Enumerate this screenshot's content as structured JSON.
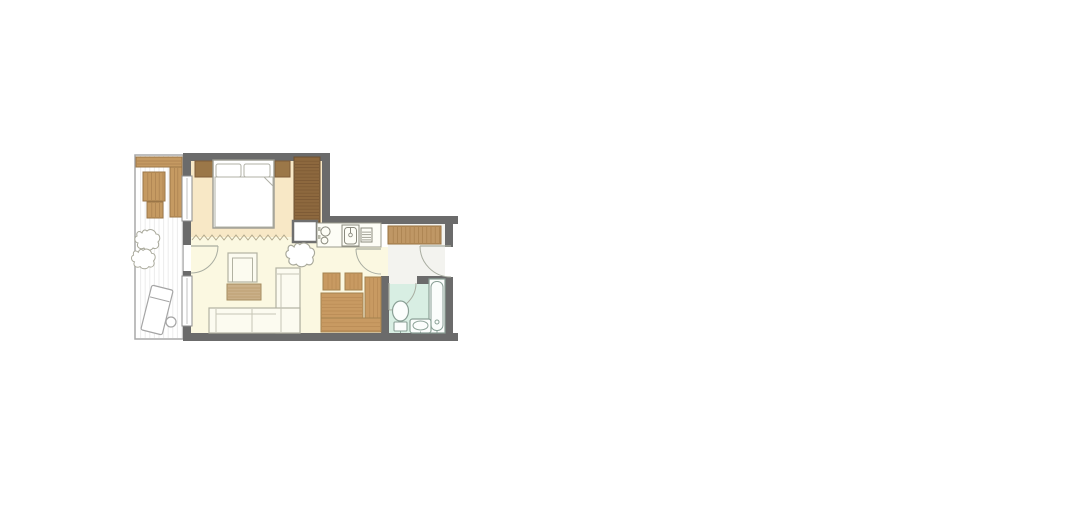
{
  "canvas": {
    "width": 1070,
    "height": 477,
    "background": "#ffffff"
  },
  "palette": {
    "wall": "#6b6b6b",
    "oak_wood": "#c59a62",
    "oak_grain": "#aa8150",
    "walnut_wood": "#8d683e",
    "walnut_grain": "#7a5733",
    "bedroom_floor": "#f8e8c6",
    "living_floor": "#fbf8e1",
    "hall_floor": "#f3f3ef",
    "bathroom_floor": "#d8eee3",
    "balcony_floor": "#ffffff",
    "furniture_outline": "#b2b2a2",
    "fixture_outline": "#8aa096",
    "door_swing": "#a9ada1"
  },
  "rooms": [
    {
      "name": "balcony"
    },
    {
      "name": "bedroom"
    },
    {
      "name": "living-room"
    },
    {
      "name": "kitchenette"
    },
    {
      "name": "hall"
    },
    {
      "name": "bathroom"
    }
  ],
  "cloud_path": "M -6 -7 C -9 -10 -12 -8 -11 -4 C -14 -3 -14 2 -10 3 C -12 7 -8 10 -4 8 C -2 11 3 11 5 8 C 9 10 12 6 10 2 C 13 -1 12 -6 8 -6 C 7 -10 2 -12 -1 -9 C -3 -11 -5 -10 -6 -7 Z",
  "shapes": [
    {
      "type": "rect",
      "name": "balcony-floor",
      "x": 95,
      "y": 139,
      "w": 48,
      "h": 184,
      "fill": "#ffffff",
      "stroke": "#a8a8a8",
      "sw": 1.5
    },
    {
      "type": "stripes",
      "name": "balcony-decking",
      "x": 96,
      "y": 140,
      "w": 46,
      "h": 182,
      "dir": "v",
      "step": 4.6,
      "color": "#ececec",
      "sw": 1
    },
    {
      "type": "rect",
      "name": "balcony-bench-top",
      "x": 96,
      "y": 141,
      "w": 46,
      "h": 10,
      "fill": "#c59a62",
      "stroke": "#9a7547",
      "sw": 1
    },
    {
      "type": "stripes",
      "name": "balcony-bench-top-grain",
      "x": 97,
      "y": 142,
      "w": 44,
      "h": 8,
      "dir": "h",
      "step": 3,
      "color": "#aa8150",
      "sw": 0.7
    },
    {
      "type": "rect",
      "name": "balcony-bench-side",
      "x": 130,
      "y": 151,
      "w": 12,
      "h": 50,
      "fill": "#c59a62",
      "stroke": "#9a7547",
      "sw": 1
    },
    {
      "type": "stripes",
      "name": "balcony-bench-side-grain",
      "x": 131,
      "y": 152,
      "w": 10,
      "h": 48,
      "dir": "v",
      "step": 3.4,
      "color": "#aa8150",
      "sw": 0.7
    },
    {
      "type": "rect",
      "name": "balcony-table",
      "x": 103,
      "y": 156,
      "w": 22,
      "h": 29,
      "fill": "#c59a62",
      "stroke": "#9a7547",
      "sw": 1
    },
    {
      "type": "stripes",
      "name": "balcony-table-grain",
      "x": 104,
      "y": 157,
      "w": 20,
      "h": 27,
      "dir": "v",
      "step": 3.8,
      "color": "#aa8150",
      "sw": 0.7
    },
    {
      "type": "rect",
      "name": "balcony-stool",
      "x": 107,
      "y": 186,
      "w": 16,
      "h": 16,
      "fill": "#c59a62",
      "stroke": "#9a7547",
      "sw": 1
    },
    {
      "type": "stripes",
      "name": "balcony-stool-grain",
      "x": 108,
      "y": 187,
      "w": 14,
      "h": 14,
      "dir": "v",
      "step": 3.8,
      "color": "#aa8150",
      "sw": 0.7
    },
    {
      "type": "cloud",
      "name": "balcony-plant-icon",
      "transform": "translate(108,224)",
      "fill": "#ffffff",
      "stroke": "#a9a99b",
      "sw": 1
    },
    {
      "type": "cloud",
      "name": "balcony-plant-icon",
      "transform": "translate(104,243) scale(0.95)",
      "fill": "#ffffff",
      "stroke": "#a9a99b",
      "sw": 1
    },
    {
      "type": "rect",
      "name": "balcony-lounger",
      "x": 106,
      "y": 271,
      "w": 22,
      "h": 46,
      "rx": 2,
      "fill": "#ffffff",
      "stroke": "#a5a5a5",
      "sw": 1.2,
      "transform": "rotate(14 117 294)"
    },
    {
      "type": "line",
      "name": "balcony-lounger-headrest",
      "x1": 107,
      "y1": 283,
      "x2": 127,
      "y2": 283,
      "stroke": "#a5a5a5",
      "sw": 1,
      "transform": "rotate(14 117 294)"
    },
    {
      "type": "circle",
      "name": "balcony-side-table",
      "cx": 131,
      "cy": 306,
      "r": 5,
      "fill": "#ffffff",
      "stroke": "#a5a5a5",
      "sw": 1.2
    },
    {
      "type": "rect",
      "name": "bedroom-floor",
      "x": 151,
      "y": 145,
      "w": 131,
      "h": 76,
      "fill": "#f8e8c6"
    },
    {
      "type": "rect",
      "name": "kitchen-floor",
      "x": 282,
      "y": 207,
      "w": 59,
      "h": 14,
      "fill": "#fbf8e1"
    },
    {
      "type": "rect",
      "name": "living-floor",
      "x": 151,
      "y": 221,
      "w": 190,
      "h": 96,
      "fill": "#fbf8e1"
    },
    {
      "type": "rect",
      "name": "kitchen-hall-doorway-floor",
      "x": 341,
      "y": 231,
      "w": 8,
      "h": 29,
      "fill": "#fbf8e1"
    },
    {
      "type": "rect",
      "name": "hall-floor",
      "x": 348,
      "y": 208,
      "w": 57,
      "h": 52,
      "fill": "#f3f3ef"
    },
    {
      "type": "rect",
      "name": "bath-doorway-floor",
      "x": 349,
      "y": 260,
      "w": 28,
      "h": 8,
      "fill": "#f3f3ef"
    },
    {
      "type": "rect",
      "name": "bathroom-floor",
      "x": 349,
      "y": 268,
      "w": 56,
      "h": 49,
      "fill": "#d8eee3"
    },
    {
      "type": "rect",
      "name": "wall-bedroom-top",
      "x": 143,
      "y": 137,
      "w": 147,
      "h": 8,
      "fill": "#6b6b6b"
    },
    {
      "type": "rect",
      "name": "wall-left-upper",
      "x": 143,
      "y": 137,
      "w": 8,
      "h": 24,
      "fill": "#6b6b6b"
    },
    {
      "type": "rect",
      "name": "wall-left-middle",
      "x": 143,
      "y": 204,
      "w": 8,
      "h": 25,
      "fill": "#6b6b6b"
    },
    {
      "type": "rect",
      "name": "wall-left-jamb",
      "x": 143,
      "y": 255,
      "w": 8,
      "h": 6,
      "fill": "#6b6b6b"
    },
    {
      "type": "rect",
      "name": "wall-left-lower",
      "x": 143,
      "y": 309,
      "w": 8,
      "h": 16,
      "fill": "#6b6b6b"
    },
    {
      "type": "rect",
      "name": "wall-bedroom-right",
      "x": 282,
      "y": 137,
      "w": 8,
      "h": 70,
      "fill": "#6b6b6b"
    },
    {
      "type": "rect",
      "name": "wall-top-right-section",
      "x": 282,
      "y": 200,
      "w": 136,
      "h": 8,
      "fill": "#6b6b6b"
    },
    {
      "type": "rect",
      "name": "wall-right-upper",
      "x": 405,
      "y": 208,
      "w": 8,
      "h": 23,
      "fill": "#6b6b6b"
    },
    {
      "type": "rect",
      "name": "wall-right-lower",
      "x": 405,
      "y": 261,
      "w": 8,
      "h": 64,
      "fill": "#6b6b6b"
    },
    {
      "type": "rect",
      "name": "wall-bottom",
      "x": 143,
      "y": 317,
      "w": 275,
      "h": 8,
      "fill": "#6b6b6b"
    },
    {
      "type": "rect",
      "name": "wall-living-bath",
      "x": 341,
      "y": 260,
      "w": 8,
      "h": 57,
      "fill": "#6b6b6b"
    },
    {
      "type": "rect",
      "name": "wall-bath-top",
      "x": 377,
      "y": 260,
      "w": 28,
      "h": 8,
      "fill": "#6b6b6b"
    },
    {
      "type": "rect",
      "name": "bedroom-window",
      "x": 142,
      "y": 160,
      "w": 10,
      "h": 45,
      "fill": "#ffffff",
      "stroke": "#8d8d8d",
      "sw": 1
    },
    {
      "type": "line",
      "name": "bedroom-window-glass",
      "x1": 147,
      "y1": 162,
      "x2": 147,
      "y2": 203,
      "stroke": "#c2c2c2",
      "sw": 1
    },
    {
      "type": "rect",
      "name": "living-window",
      "x": 142,
      "y": 260,
      "w": 10,
      "h": 50,
      "fill": "#ffffff",
      "stroke": "#8d8d8d",
      "sw": 1
    },
    {
      "type": "line",
      "name": "living-window-glass",
      "x1": 147,
      "y1": 262,
      "x2": 147,
      "y2": 308,
      "stroke": "#c2c2c2",
      "sw": 1
    },
    {
      "type": "polyline",
      "name": "curtain-divider",
      "points": "152,224 156,219 160,224 164,219 168,224 172,219 176,224 180,219 184,224 188,219 192,224 196,219 200,224 204,219 208,224 212,219 216,224 220,219 224,224 228,219 232,224 236,219 240,224 244,219 248,224",
      "stroke": "#b3a98d",
      "sw": 1,
      "fill": "none"
    },
    {
      "type": "rect",
      "name": "nightstand-left",
      "x": 155,
      "y": 145,
      "w": 18,
      "h": 16,
      "fill": "#9b7748",
      "stroke": "#7f5c38",
      "sw": 1
    },
    {
      "type": "rect",
      "name": "nightstand-right",
      "x": 235,
      "y": 145,
      "w": 15,
      "h": 16,
      "fill": "#9b7748",
      "stroke": "#7f5c38",
      "sw": 1
    },
    {
      "type": "rect",
      "name": "double-bed",
      "x": 173,
      "y": 144,
      "w": 61,
      "h": 68,
      "fill": "#ffffff",
      "stroke": "#9c9c92",
      "sw": 1.4
    },
    {
      "type": "rect",
      "name": "bed-pillow-left",
      "x": 176,
      "y": 148,
      "w": 25,
      "h": 13,
      "rx": 2,
      "fill": "#ffffff",
      "stroke": "#b0b0a6",
      "sw": 1
    },
    {
      "type": "rect",
      "name": "bed-pillow-right",
      "x": 204,
      "y": 148,
      "w": 26,
      "h": 13,
      "rx": 2,
      "fill": "#ffffff",
      "stroke": "#b0b0a6",
      "sw": 1
    },
    {
      "type": "rect",
      "name": "bed-duvet",
      "x": 175,
      "y": 161,
      "w": 58,
      "h": 50,
      "fill": "#ffffff",
      "stroke": "#b0b0a6",
      "sw": 1
    },
    {
      "type": "path",
      "name": "bed-duvet-fold",
      "d": "M 233 161 L 224 161 L 233 170 Z",
      "fill": "#ffffff",
      "stroke": "#b0b0a6",
      "sw": 1
    },
    {
      "type": "rect",
      "name": "bedroom-wardrobe",
      "x": 254,
      "y": 141,
      "w": 26,
      "h": 65,
      "fill": "#8d683e",
      "stroke": "#6d5130",
      "sw": 1
    },
    {
      "type": "stripes",
      "name": "bedroom-wardrobe-grain",
      "x": 255,
      "y": 142,
      "w": 24,
      "h": 63,
      "dir": "h",
      "step": 3.2,
      "color": "#7a5733",
      "sw": 0.7
    },
    {
      "type": "rect",
      "name": "utility-column",
      "x": 253,
      "y": 205,
      "w": 24,
      "h": 21,
      "fill": "#ffffff",
      "stroke": "#6f6f6f",
      "sw": 2.5
    },
    {
      "type": "rect",
      "name": "kitchen-counter",
      "x": 277,
      "y": 207,
      "w": 64,
      "h": 24,
      "fill": "#fdfdf6",
      "stroke": "#9b9b8d",
      "sw": 1
    },
    {
      "type": "circle",
      "name": "stove-burner-icon",
      "cx": 285.5,
      "cy": 215.5,
      "r": 4.6,
      "fill": "none",
      "stroke": "#8a8a7e",
      "sw": 1
    },
    {
      "type": "circle",
      "name": "stove-burner-icon",
      "cx": 284.5,
      "cy": 224.5,
      "r": 3.4,
      "fill": "none",
      "stroke": "#8a8a7e",
      "sw": 1
    },
    {
      "type": "rect",
      "name": "stove-control",
      "x": 278,
      "y": 211,
      "w": 2.5,
      "h": 4,
      "fill": "#b9b9ab"
    },
    {
      "type": "rect",
      "name": "stove-control",
      "x": 278,
      "y": 219,
      "w": 2.5,
      "h": 4,
      "fill": "#b9b9ab"
    },
    {
      "type": "rect",
      "name": "kitchen-sink",
      "x": 302,
      "y": 209,
      "w": 17,
      "h": 21,
      "fill": "#fdfdf6",
      "stroke": "#8a8a7e",
      "sw": 1
    },
    {
      "type": "rect",
      "name": "kitchen-sink-basin",
      "x": 304.5,
      "y": 211.5,
      "w": 12,
      "h": 16.5,
      "rx": 3,
      "fill": "none",
      "stroke": "#8a8a7e",
      "sw": 1
    },
    {
      "type": "line",
      "name": "kitchen-faucet-icon",
      "x1": 310.5,
      "y1": 212,
      "x2": 310.5,
      "y2": 217,
      "stroke": "#8a8a7e",
      "sw": 1
    },
    {
      "type": "circle",
      "name": "kitchen-faucet-icon",
      "cx": 310.5,
      "cy": 219,
      "r": 1.8,
      "fill": "none",
      "stroke": "#8a8a7e",
      "sw": 0.9
    },
    {
      "type": "rect",
      "name": "dish-drainer",
      "x": 321,
      "y": 212,
      "w": 11,
      "h": 14,
      "fill": "none",
      "stroke": "#8a8a7e",
      "sw": 1
    },
    {
      "type": "stripes",
      "name": "dish-drainer-slats",
      "x": 322,
      "y": 213.5,
      "w": 9,
      "h": 11.5,
      "dir": "h",
      "step": 2.6,
      "color": "#8a8a7e",
      "sw": 0.8
    },
    {
      "type": "rect",
      "name": "armchair",
      "x": 188,
      "y": 237,
      "w": 29,
      "h": 29,
      "fill": "#fcfbf0",
      "stroke": "#b2b2a2",
      "sw": 1.2
    },
    {
      "type": "path",
      "name": "armchair-cushion-lines",
      "d": "M 192.5 266 L 192.5 242 L 212.5 242 L 212.5 266",
      "fill": "none",
      "stroke": "#b2b2a2",
      "sw": 1
    },
    {
      "type": "rect",
      "name": "coffee-table",
      "x": 187,
      "y": 268,
      "w": 34,
      "h": 16,
      "fill": "#cab089",
      "stroke": "#a68c5e",
      "sw": 1
    },
    {
      "type": "stripes",
      "name": "coffee-table-grain",
      "x": 188,
      "y": 269,
      "w": 32,
      "h": 14,
      "dir": "h",
      "step": 3,
      "color": "#b89a6b",
      "sw": 0.8
    },
    {
      "type": "rect",
      "name": "sofa-chaise",
      "x": 236,
      "y": 252,
      "w": 24,
      "h": 65,
      "fill": "#fcfbf0",
      "stroke": "#b2b2a2",
      "sw": 1.2
    },
    {
      "type": "rect",
      "name": "sofa-seat",
      "x": 169,
      "y": 292,
      "w": 91,
      "h": 25,
      "fill": "#fcfbf0",
      "stroke": "#b2b2a2",
      "sw": 1.2
    },
    {
      "type": "path",
      "name": "sofa-cushion-lines",
      "d": "M 176 293 L 176 316 M 212 293 L 212 316 M 176 298 L 236 298 M 241 258 L 241 316 M 237 258 L 259 258",
      "fill": "none",
      "stroke": "#c6c6b6",
      "sw": 1
    },
    {
      "type": "cloud",
      "name": "living-plant-icon",
      "transform": "translate(261,239) scale(1.15)",
      "fill": "#ffffff",
      "stroke": "#a9a99b",
      "sw": 1
    },
    {
      "type": "rect",
      "name": "dining-chair",
      "x": 283,
      "y": 257,
      "w": 17,
      "h": 17,
      "fill": "#c89a62",
      "stroke": "#a3824f",
      "sw": 1
    },
    {
      "type": "stripes",
      "name": "dining-chair-grain",
      "x": 284,
      "y": 258,
      "w": 15,
      "h": 15,
      "dir": "v",
      "step": 4,
      "color": "#b78a54",
      "sw": 0.7
    },
    {
      "type": "rect",
      "name": "dining-chair",
      "x": 305,
      "y": 257,
      "w": 17,
      "h": 17,
      "fill": "#c89a62",
      "stroke": "#a3824f",
      "sw": 1
    },
    {
      "type": "stripes",
      "name": "dining-chair-grain",
      "x": 306,
      "y": 258,
      "w": 15,
      "h": 15,
      "dir": "v",
      "step": 4,
      "color": "#b78a54",
      "sw": 0.7
    },
    {
      "type": "rect",
      "name": "dining-table",
      "x": 281,
      "y": 277,
      "w": 42,
      "h": 25,
      "fill": "#c89a62",
      "stroke": "#a3824f",
      "sw": 1
    },
    {
      "type": "stripes",
      "name": "dining-table-grain",
      "x": 282,
      "y": 278,
      "w": 40,
      "h": 23,
      "dir": "h",
      "step": 3.4,
      "color": "#b78a54",
      "sw": 0.7
    },
    {
      "type": "rect",
      "name": "corner-bench-vertical",
      "x": 325,
      "y": 261,
      "w": 16,
      "h": 55,
      "fill": "#c89a62",
      "stroke": "#a3824f",
      "sw": 1
    },
    {
      "type": "stripes",
      "name": "corner-bench-vertical-grain",
      "x": 326,
      "y": 262,
      "w": 14,
      "h": 53,
      "dir": "v",
      "step": 3.8,
      "color": "#b78a54",
      "sw": 0.7
    },
    {
      "type": "rect",
      "name": "corner-bench-horizontal",
      "x": 281,
      "y": 302,
      "w": 60,
      "h": 14,
      "fill": "#c89a62",
      "stroke": "#a3824f",
      "sw": 1
    },
    {
      "type": "stripes",
      "name": "corner-bench-horizontal-grain",
      "x": 282,
      "y": 303,
      "w": 58,
      "h": 12,
      "dir": "h",
      "step": 3.8,
      "color": "#b78a54",
      "sw": 0.7
    },
    {
      "type": "rect",
      "name": "hall-wardrobe",
      "x": 348,
      "y": 210,
      "w": 53,
      "h": 18,
      "fill": "#bf9765",
      "stroke": "#97703f",
      "sw": 1
    },
    {
      "type": "stripes",
      "name": "hall-wardrobe-grain",
      "x": 349,
      "y": 211,
      "w": 51,
      "h": 16,
      "dir": "v",
      "step": 4.2,
      "color": "#a87f4e",
      "sw": 0.7
    },
    {
      "type": "line",
      "name": "balcony-door-leaf",
      "x1": 151,
      "y1": 230,
      "x2": 178,
      "y2": 230,
      "stroke": "#a9ada1",
      "sw": 1.2
    },
    {
      "type": "path",
      "name": "balcony-door-swing",
      "d": "M 178 230 A 27 27 0 0 1 151 257",
      "fill": "none",
      "stroke": "#a9ada1",
      "sw": 1
    },
    {
      "type": "line",
      "name": "kitchen-hall-door-leaf",
      "x1": 341,
      "y1": 233,
      "x2": 316,
      "y2": 233,
      "stroke": "#a9ada1",
      "sw": 1.2
    },
    {
      "type": "path",
      "name": "kitchen-hall-door-swing",
      "d": "M 316 233 A 25 25 0 0 0 341 258",
      "fill": "none",
      "stroke": "#a9ada1",
      "sw": 1
    },
    {
      "type": "line",
      "name": "entry-door-leaf",
      "x1": 411,
      "y1": 230,
      "x2": 380,
      "y2": 230,
      "stroke": "#a9ada1",
      "sw": 1.2
    },
    {
      "type": "path",
      "name": "entry-door-swing",
      "d": "M 380 230 A 31 31 0 0 0 411 261",
      "fill": "none",
      "stroke": "#a9ada1",
      "sw": 1
    },
    {
      "type": "line",
      "name": "bathroom-door-leaf",
      "x1": 349,
      "y1": 267,
      "x2": 349,
      "y2": 294,
      "stroke": "#a9ada1",
      "sw": 1.2
    },
    {
      "type": "path",
      "name": "bathroom-door-swing",
      "d": "M 349 294 A 27 27 0 0 0 376 267",
      "fill": "none",
      "stroke": "#a9ada1",
      "sw": 1
    },
    {
      "type": "rect",
      "name": "bathtub",
      "x": 389,
      "y": 263,
      "w": 16,
      "h": 54,
      "fill": "#fbfdfc",
      "stroke": "#8aa096",
      "sw": 1.2
    },
    {
      "type": "rect",
      "name": "bathtub-basin",
      "x": 391,
      "y": 265.5,
      "w": 12,
      "h": 49,
      "rx": 5.5,
      "fill": "none",
      "stroke": "#8aa096",
      "sw": 1
    },
    {
      "type": "circle",
      "name": "bathtub-drain",
      "cx": 397,
      "cy": 306,
      "r": 2,
      "fill": "none",
      "stroke": "#8aa096",
      "sw": 1
    },
    {
      "type": "rect",
      "name": "toilet-tank",
      "x": 354,
      "y": 306,
      "w": 13,
      "h": 9,
      "rx": 1,
      "fill": "#fbfdfc",
      "stroke": "#8aa096",
      "sw": 1.1
    },
    {
      "type": "ellipse",
      "name": "toilet-bowl",
      "cx": 360.5,
      "cy": 295,
      "rx": 8,
      "ry": 10,
      "fill": "#fbfdfc",
      "stroke": "#8aa096",
      "sw": 1.2
    },
    {
      "type": "rect",
      "name": "bathroom-sink",
      "x": 370,
      "y": 303,
      "w": 21,
      "h": 14,
      "rx": 2.5,
      "fill": "#fbfdfc",
      "stroke": "#8aa096",
      "sw": 1.2
    },
    {
      "type": "ellipse",
      "name": "bathroom-sink-basin",
      "cx": 380.5,
      "cy": 309.5,
      "rx": 7.5,
      "ry": 4.5,
      "fill": "none",
      "stroke": "#8aa096",
      "sw": 1
    },
    {
      "type": "path",
      "name": "bathroom-tap-marks",
      "d": "M 360.5 314.5 L 360.5 317 M 380.5 315.5 L 380.5 317.5 M 397 314 L 397 316.5",
      "fill": "none",
      "stroke": "#8aa096",
      "sw": 1
    }
  ]
}
